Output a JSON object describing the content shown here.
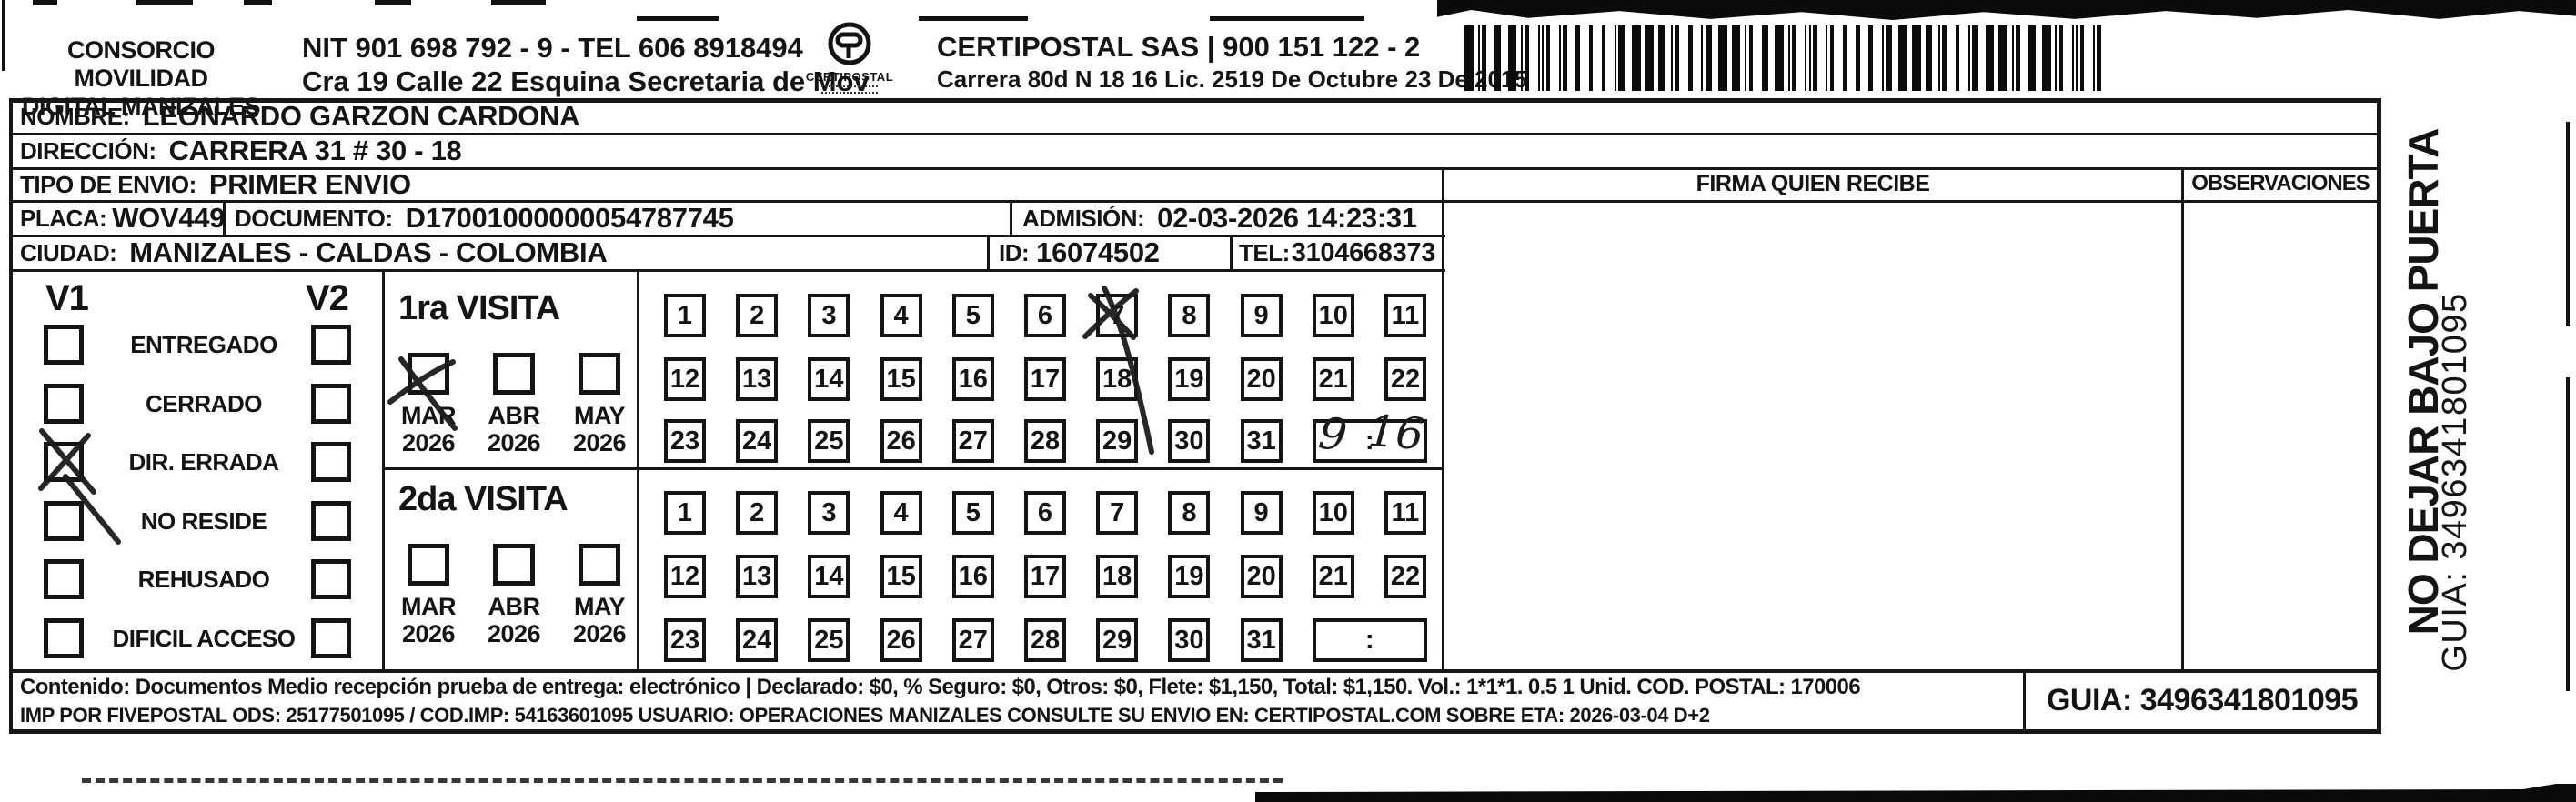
{
  "header": {
    "company_line1": "CONSORCIO MOVILIDAD",
    "company_line2": "DIGITAL MANIZALES",
    "nit_tel": "NIT 901 698 792 - 9 - TEL 606 8918494",
    "address": "Cra 19 Calle 22 Esquina Secretaria de Mov",
    "logo_text": "CERTIPOSTAL",
    "carrier_line1": "CERTIPOSTAL SAS | 900 151 122 - 2",
    "carrier_line2": "Carrera 80d N 18 16  Lic. 2519 De Octubre 23 De 2015"
  },
  "recipient": {
    "nombre_label": "NOMBRE:",
    "nombre": "LEONARDO GARZON CARDONA",
    "direccion_label": "DIRECCIÓN:",
    "direccion": "CARRERA 31 # 30 - 18",
    "tipo_envio_label": "TIPO DE ENVIO:",
    "tipo_envio": "PRIMER ENVIO",
    "placa_label": "PLACA:",
    "placa": "WOV449",
    "documento_label": "DOCUMENTO:",
    "documento": "D17001000000054787745",
    "admision_label": "ADMISIÓN:",
    "admision": "02-03-2026 14:23:31",
    "ciudad_label": "CIUDAD:",
    "ciudad": "MANIZALES - CALDAS - COLOMBIA",
    "id_label": "ID:",
    "id": "16074502",
    "tel_label": "TEL:",
    "tel": "3104668373"
  },
  "columns": {
    "firma_header": "FIRMA QUIEN RECIBE",
    "observaciones_header": "OBSERVACIONES"
  },
  "status_panel": {
    "v1_label": "V1",
    "v2_label": "V2",
    "statuses": [
      "ENTREGADO",
      "CERRADO",
      "DIR. ERRADA",
      "NO RESIDE",
      "REHUSADO",
      "DIFICIL ACCESO"
    ],
    "v1_checked": "DIR. ERRADA"
  },
  "visits": {
    "first": {
      "title": "1ra VISITA",
      "months": [
        {
          "month": "MAR",
          "year": "2026",
          "checked": true
        },
        {
          "month": "ABR",
          "year": "2026",
          "checked": false
        },
        {
          "month": "MAY",
          "year": "2026",
          "checked": false
        }
      ],
      "days": [
        1,
        2,
        3,
        4,
        5,
        6,
        7,
        8,
        9,
        10,
        11,
        12,
        13,
        14,
        15,
        16,
        17,
        18,
        19,
        20,
        21,
        22,
        23,
        24,
        25,
        26,
        27,
        28,
        29,
        30,
        31
      ],
      "crossed_day": 7,
      "time_separator": ":",
      "handwritten_time": {
        "hour": "9",
        "minutes": "16"
      }
    },
    "second": {
      "title": "2da VISITA",
      "months": [
        {
          "month": "MAR",
          "year": "2026",
          "checked": false
        },
        {
          "month": "ABR",
          "year": "2026",
          "checked": false
        },
        {
          "month": "MAY",
          "year": "2026",
          "checked": false
        }
      ],
      "days": [
        1,
        2,
        3,
        4,
        5,
        6,
        7,
        8,
        9,
        10,
        11,
        12,
        13,
        14,
        15,
        16,
        17,
        18,
        19,
        20,
        21,
        22,
        23,
        24,
        25,
        26,
        27,
        28,
        29,
        30,
        31
      ],
      "time_separator": ":"
    }
  },
  "footer": {
    "line1": "Contenido: Documentos Medio recepción prueba de entrega: electrónico | Declarado: $0, % Seguro: $0, Otros: $0, Flete: $1,150, Total: $1,150. Vol.: 1*1*1. 0.5  1 Unid. COD. POSTAL: 170006",
    "line2": "IMP POR FIVEPOSTAL ODS: 25177501095 / COD.IMP: 54163601095 USUARIO: OPERACIONES MANIZALES CONSULTE SU ENVIO EN: CERTIPOSTAL.COM SOBRE ETA: 2026-03-04 D+2",
    "guia": "GUIA: 3496341801095"
  },
  "side_note": {
    "warning": "NO DEJAR BAJO PUERTA",
    "guia": "GUIA: 3496341801095"
  }
}
